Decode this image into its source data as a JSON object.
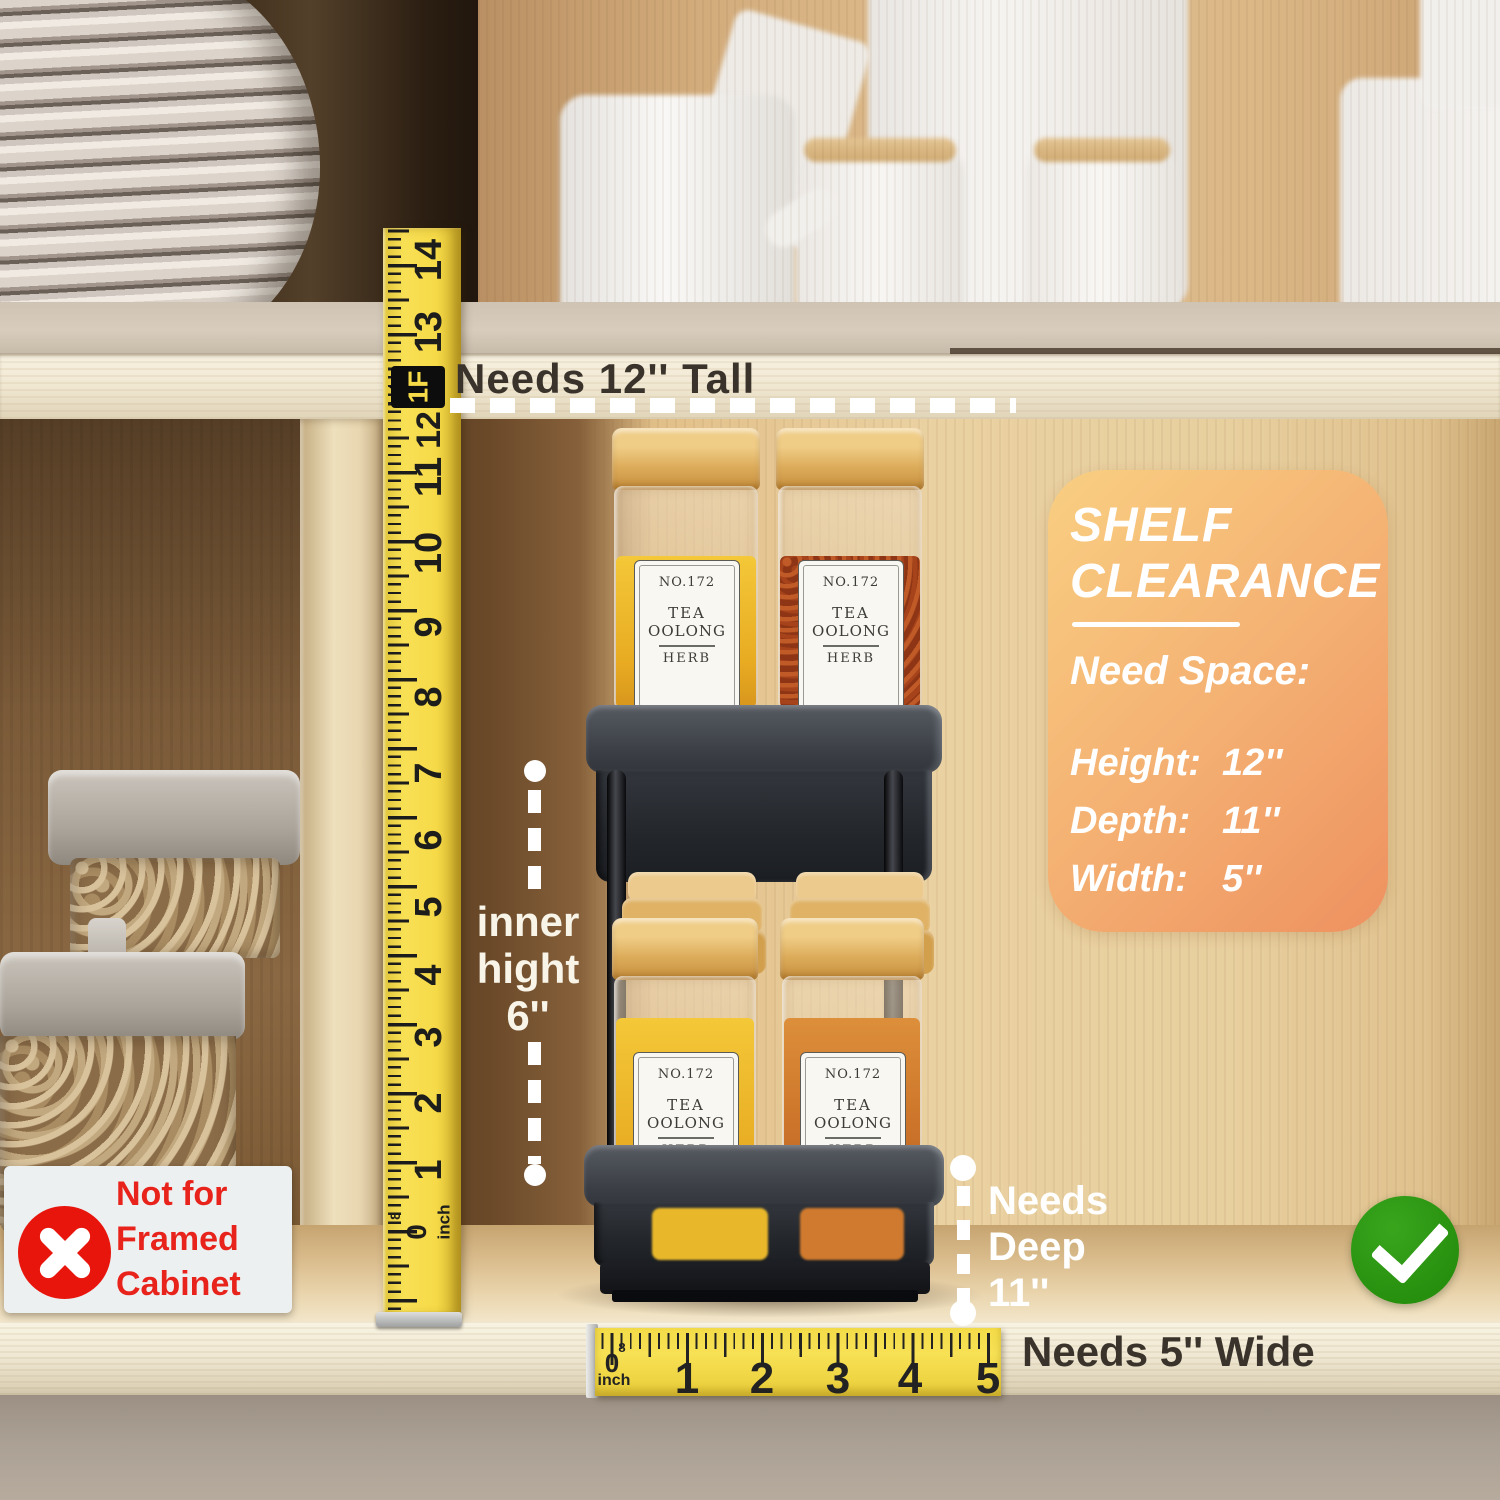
{
  "labels": {
    "needs_tall": "Needs 12'' Tall",
    "needs_wide": "Needs 5'' Wide",
    "inner_height": {
      "line1": "inner",
      "line2": "hight",
      "line3": "6''"
    },
    "needs_deep": {
      "line1": "Needs",
      "line2": "Deep",
      "line3": "11''"
    },
    "not_for_framed": {
      "line1": "Not for",
      "line2": "Framed",
      "line3": "Cabinet"
    }
  },
  "badge": {
    "title1": "SHELF",
    "title2": "CLEARANCE",
    "subtitle": "Need Space:",
    "specs": [
      {
        "label": "Height:",
        "value": "12''"
      },
      {
        "label": "Depth:",
        "value": "11''"
      },
      {
        "label": "Width:",
        "value": "5''"
      }
    ],
    "gradient_start": "#f9cf82",
    "gradient_end": "#ee9160",
    "text_color": "#ffffff"
  },
  "tape_vertical": {
    "numbers": [
      "14",
      "13",
      "11",
      "10",
      "9",
      "8",
      "7",
      "6",
      "5",
      "4",
      "3",
      "2",
      "1"
    ],
    "foot_marker": "1F",
    "foot_number": "12",
    "zero": "0",
    "unit": "inch",
    "eighth": "8"
  },
  "ruler_horizontal": {
    "numbers": [
      "0",
      "1",
      "2",
      "3",
      "4",
      "5"
    ],
    "unit": "inch",
    "eighth": "8"
  },
  "spice_label": {
    "no": "NO.172",
    "name1": "TEA",
    "name2": "OOLONG",
    "sub": "HERB"
  },
  "colors": {
    "check_green": "#268f0e",
    "cross_red": "#e8150d",
    "red_text": "#e8231b",
    "annotation_white": "#ffffff",
    "annotation_dark": "#3a332b",
    "tape_yellow": "#f6da48"
  }
}
